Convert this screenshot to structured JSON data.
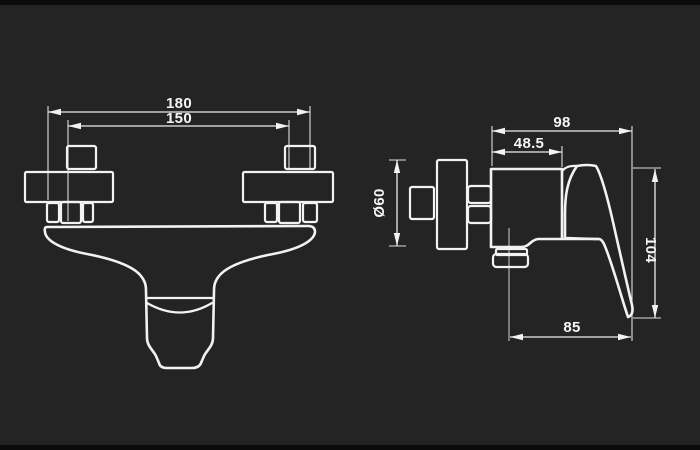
{
  "colors": {
    "background": "#242424",
    "letterbox": "#0b0b0b",
    "line": "#f2f2f2",
    "text": "#f5f5f5"
  },
  "front_view": {
    "dim_width_outer": "180",
    "dim_width_centers": "150"
  },
  "side_view": {
    "dim_depth_total": "98",
    "dim_depth_body": "48.5",
    "dim_flange_diameter": "Ø60",
    "dim_height_total": "104",
    "dim_reach_bottom": "85"
  }
}
